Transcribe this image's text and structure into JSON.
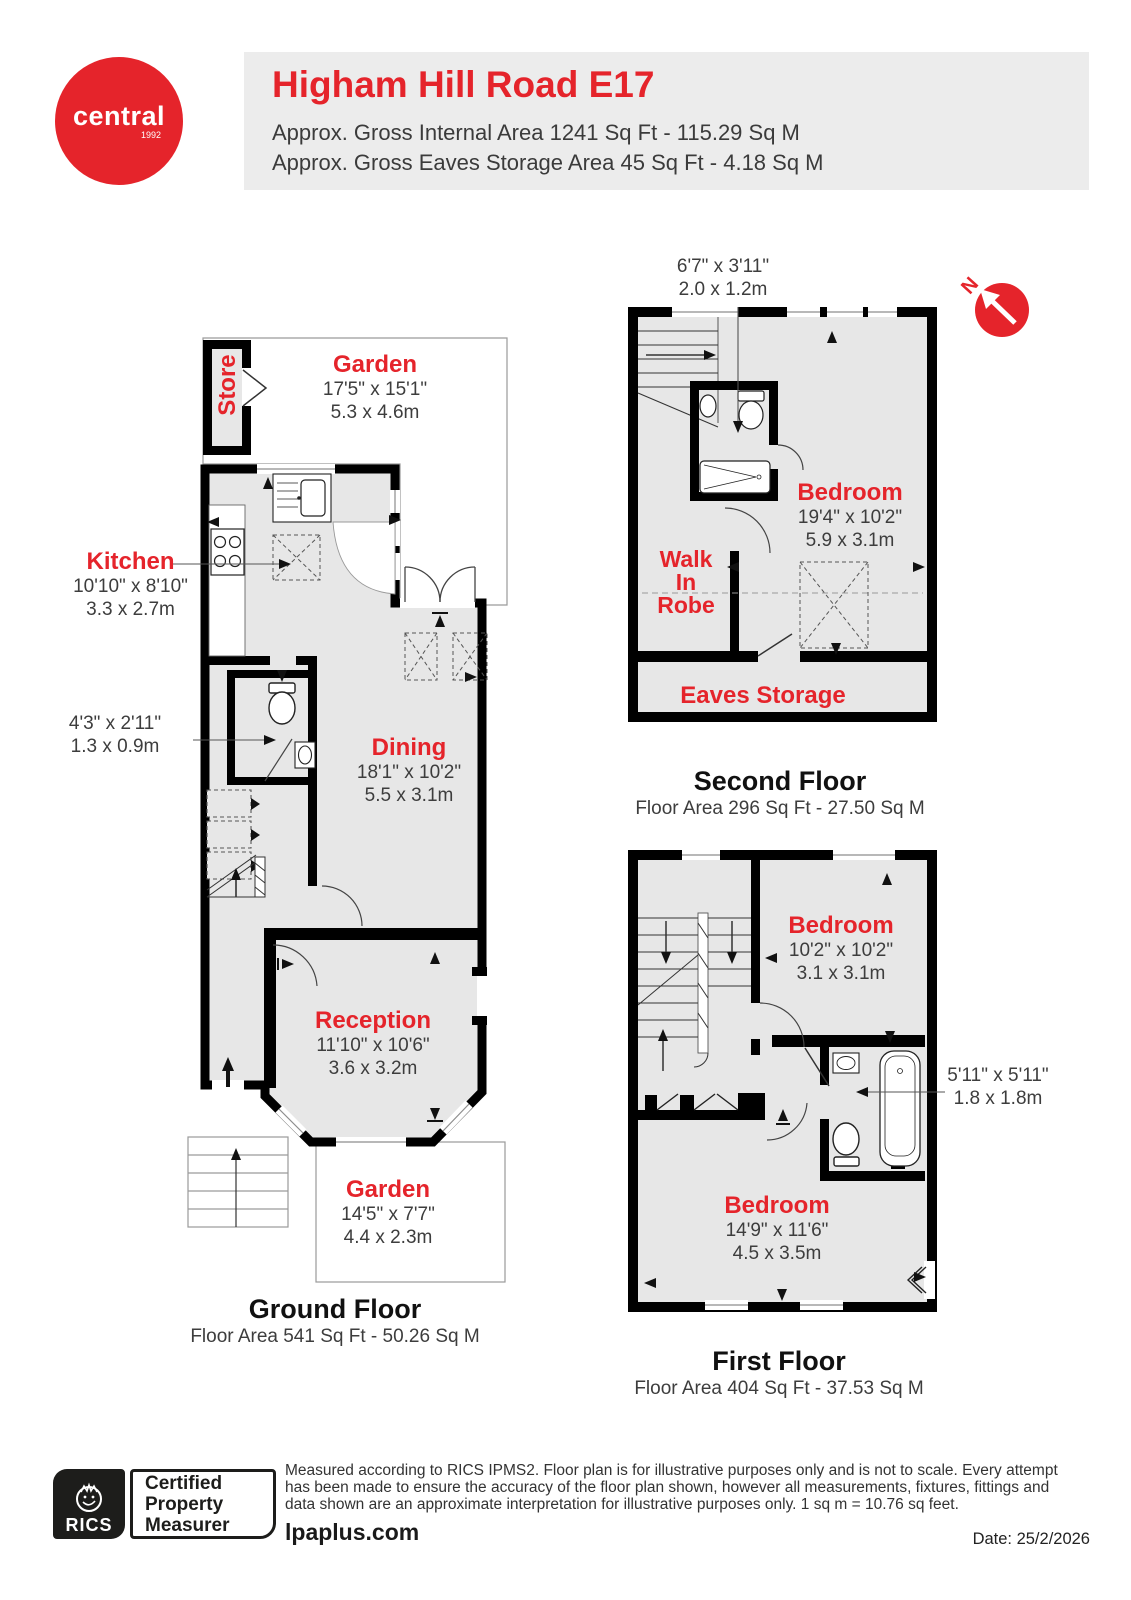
{
  "header": {
    "logo_brand": "central",
    "logo_year": "1992",
    "title": "Higham Hill Road E17",
    "subtitle1": "Approx. Gross Internal Area 1241 Sq Ft - 115.29 Sq M",
    "subtitle2": "Approx. Gross Eaves Storage Area 45 Sq Ft - 4.18 Sq M"
  },
  "colors": {
    "accent": "#e5242b",
    "wall": "#000000",
    "floor": "#e7e7e7"
  },
  "compass": {
    "north": "N"
  },
  "floors": {
    "ground": {
      "caption": "Ground Floor",
      "area": "Floor Area 541 Sq Ft - 50.26 Sq M",
      "rooms": {
        "garden_top": {
          "name": "Garden",
          "imperial": "17'5\" x 15'1\"",
          "metric": "5.3 x 4.6m"
        },
        "store": {
          "name": "Store"
        },
        "kitchen": {
          "name": "Kitchen",
          "imperial": "10'10\" x 8'10\"",
          "metric": "3.3 x 2.7m"
        },
        "wc": {
          "imperial": "4'3\" x 2'11\"",
          "metric": "1.3 x 0.9m"
        },
        "dining": {
          "name": "Dining",
          "imperial": "18'1\" x 10'2\"",
          "metric": "5.5 x 3.1m"
        },
        "reception": {
          "name": "Reception",
          "imperial": "11'10\" x 10'6\"",
          "metric": "3.6 x 3.2m"
        },
        "garden_bottom": {
          "name": "Garden",
          "imperial": "14'5\" x 7'7\"",
          "metric": "4.4 x 2.3m"
        }
      }
    },
    "second": {
      "caption": "Second Floor",
      "area": "Floor Area 296 Sq Ft - 27.50 Sq M",
      "rooms": {
        "shower": {
          "imperial": "6'7\" x 3'11\"",
          "metric": "2.0 x 1.2m"
        },
        "bedroom": {
          "name": "Bedroom",
          "imperial": "19'4\" x 10'2\"",
          "metric": "5.9 x 3.1m"
        },
        "walk_in_robe": {
          "name": "Walk In Robe"
        },
        "eaves": {
          "name": "Eaves Storage"
        }
      }
    },
    "first": {
      "caption": "First Floor",
      "area": "Floor Area 404 Sq Ft - 37.53 Sq M",
      "rooms": {
        "bedroom_top": {
          "name": "Bedroom",
          "imperial": "10'2\" x 10'2\"",
          "metric": "3.1 x 3.1m"
        },
        "bathroom": {
          "imperial": "5'11\" x 5'11\"",
          "metric": "1.8 x 1.8m"
        },
        "bedroom_bottom": {
          "name": "Bedroom",
          "imperial": "14'9\" x 11'6\"",
          "metric": "4.5 x 3.5m"
        }
      }
    }
  },
  "footer": {
    "rics_brand": "RICS",
    "badge_line1": "Certified",
    "badge_line2": "Property",
    "badge_line3": "Measurer",
    "disclaimer": "Measured according to RICS IPMS2. Floor plan is for illustrative purposes only and is not to scale. Every attempt has been made to ensure the accuracy of the floor plan shown, however all measurements, fixtures, fittings and data shown are an approximate interpretation for illustrative purposes only. 1 sq m = 10.76 sq feet.",
    "website": "lpaplus.com",
    "date": "Date: 25/2/2026"
  }
}
